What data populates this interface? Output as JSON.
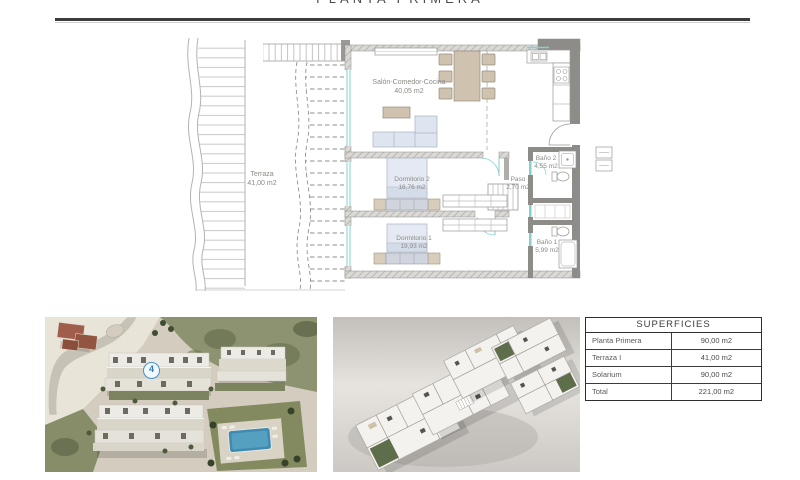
{
  "page": {
    "title": "PLANTA PRIMERA"
  },
  "floor_plan": {
    "rooms": {
      "salon": {
        "name": "Salón-Comedor-Cocina",
        "area": "40,05 m2"
      },
      "terraza": {
        "name": "Terraza",
        "area": "41,00 m2"
      },
      "dormitorio2": {
        "name": "Dormitorio 2",
        "area": "16,76 m2"
      },
      "paso": {
        "name": "Paso",
        "area": "2,70 m2"
      },
      "bano2": {
        "name": "Baño 2",
        "area": "4,55 m2"
      },
      "dormitorio1": {
        "name": "Dormitorio 1",
        "area": "19,93 m2"
      },
      "bano1": {
        "name": "Baño 1",
        "area": "5,99 m2"
      }
    }
  },
  "aerial_render": {
    "building_marker": "4"
  },
  "superficies_table": {
    "title": "SUPERFICIES",
    "rows": [
      {
        "label": "Planta Primera",
        "value": "90,00 m2"
      },
      {
        "label": "Terraza I",
        "value": "41,00 m2"
      },
      {
        "label": "Solarium",
        "value": "90,00 m2"
      },
      {
        "label": "Total",
        "value": "221,00 m2"
      }
    ]
  },
  "colors": {
    "rule_dark": "#3c3c3c",
    "wall_dark_gray": "#8e8c89",
    "wall_light_gray": "#d9d7d4",
    "glazing_cyan": "#86cfcf",
    "furniture_tan": "#cfc2ae",
    "bed_sofa_blue": "#e4e9f3",
    "pool_blue": "#3f8ab0",
    "marker_blue": "#4a90c4"
  }
}
